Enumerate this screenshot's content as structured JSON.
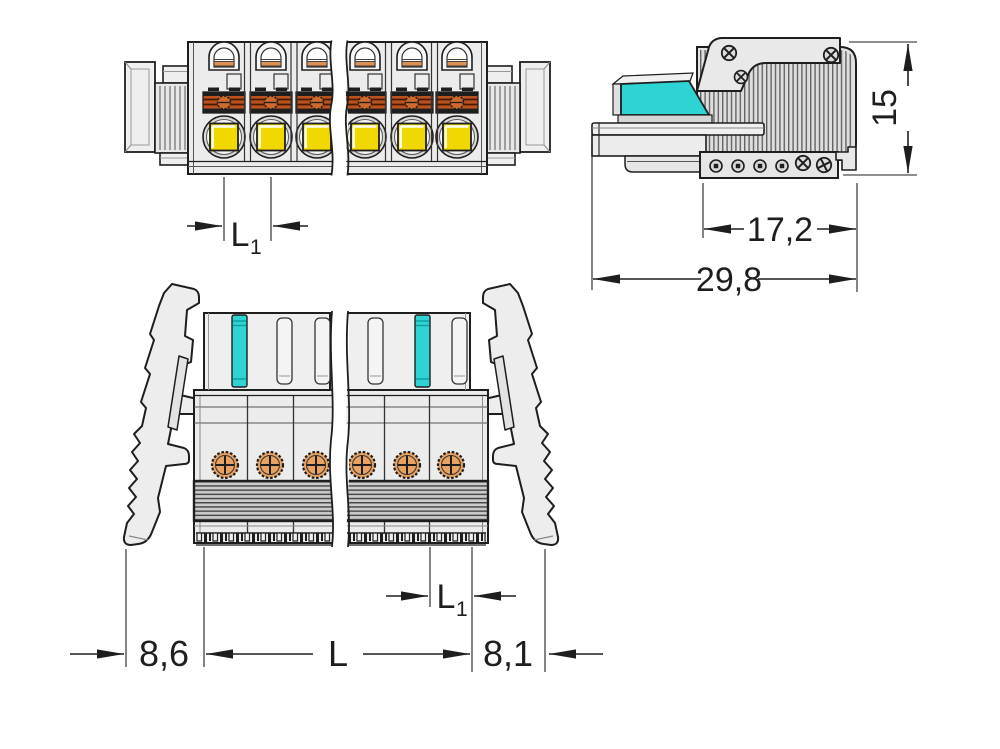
{
  "palette": {
    "outline": "#1e1e1e",
    "body_gray": "#ececec",
    "accent_cyan": "#2ed3d3",
    "accent_yellow": "#f0d800",
    "copper_band": "#b9521f",
    "contact_orange": "#e8a262"
  },
  "dimensions": {
    "front_pitch": {
      "base": "L",
      "sub": "1"
    },
    "side_height": "15",
    "side_insert_depth": "17,2",
    "side_total_depth": "29,8",
    "bottom_pitch": {
      "base": "L",
      "sub": "1"
    },
    "bottom_left_margin": "8,6",
    "bottom_length": "L",
    "bottom_right_margin": "8,1"
  }
}
